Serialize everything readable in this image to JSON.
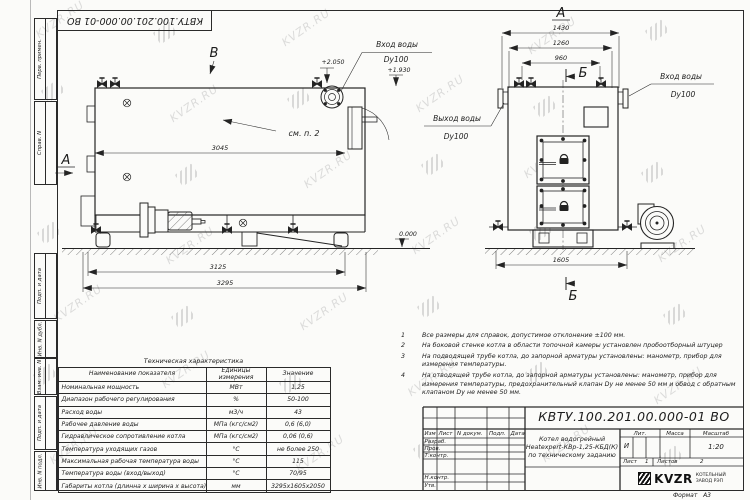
{
  "watermark": {
    "text": "KVZR.RU"
  },
  "frame": {
    "corner_stamp": "КВТУ.100.201.00.000-01 ВО",
    "margin_labels": [
      "Перв. примен.",
      "Справ. N",
      "Подп. и дата",
      "Инв. N дубл.",
      "Взам. инв. N",
      "Подп. и дата",
      "Инв. N подл."
    ]
  },
  "views": {
    "side": {
      "label": "В",
      "label_a": "А",
      "inlet": "Вход воды",
      "inlet_dn": "Dy100",
      "elev_top": "+2.050",
      "elev_mid": "+1.930",
      "elev_zero": "0.000",
      "see_note": "см. п. 2",
      "dim_inner": "3045",
      "dim_mid": "3125",
      "dim_total": "3295"
    },
    "front": {
      "label": "А",
      "section": "Б",
      "dim1": "1430",
      "dim2": "1260",
      "dim3": "960",
      "dim_base": "1605",
      "inlet": "Вход воды",
      "inlet_dn": "Dy100",
      "outlet": "Выход воды",
      "outlet_dn": "Dy100"
    }
  },
  "notes": {
    "items": [
      {
        "n": "1",
        "text": "Все размеры для справок, допустимое отклонение ±100 мм."
      },
      {
        "n": "2",
        "text": "На боковой стенке котла в области топочной камеры установлен пробоотборный штуцер"
      },
      {
        "n": "3",
        "text": "На  подводящей трубе котла, до запорной арматуры установлены: манометр, прибор для измерения температуры."
      },
      {
        "n": "4",
        "text": "На отводящей трубе котла, до запорной арматуры установлены: манометр, прибор для измерения температуры, предохранительный клапан Dу не менее 50 мм и обвод с обратным клапаном Dу не менее 50 мм."
      }
    ]
  },
  "spec_table": {
    "title": "Техническая характеристика",
    "headers": [
      "Наименование показателя",
      "Единицы измерения",
      "Значение"
    ],
    "rows": [
      [
        "Номинальная мощность",
        "МВт",
        "1,25"
      ],
      [
        "Диапазон рабочего регулирования",
        "%",
        "50-100"
      ],
      [
        "Расход воды",
        "м3/ч",
        "43"
      ],
      [
        "Рабочее давление воды",
        "МПа (кгс/см2)",
        "0,6 (6,0)"
      ],
      [
        "Гидравлическое сопротивление котла",
        "МПа (кгс/см2)",
        "0,06 (0,6)"
      ],
      [
        "Температура уходящих газов",
        "°С",
        "не более 250"
      ],
      [
        "Максимальная рабочая температура воды",
        "°С",
        "115"
      ],
      [
        "Температура воды (вход/выход)",
        "°С",
        "70/95"
      ],
      [
        "Габариты котла (длинна х ширина х высота)",
        "мм",
        "3295х1605х2050"
      ]
    ]
  },
  "title_block": {
    "doc_number": "КВТУ.100.201.00.000-01 ВО",
    "cols": [
      "Изм",
      "Лист",
      "N докум.",
      "Подп.",
      "Дата"
    ],
    "rows": [
      "Разраб.",
      "Пров.",
      "Т.контр.",
      "Н.контр.",
      "Утв."
    ],
    "product": [
      "Котел водогрейный",
      "Heatexpert-КВр-1,25-КБД(К)",
      "по техническому заданию"
    ],
    "lit_label": "Лит.",
    "lit_value": "И",
    "mass_label": "Масса",
    "scale_label": "Масштаб",
    "scale_value": "1:20",
    "sheet_label": "Лист",
    "sheet_value": "1",
    "sheets_label": "Листов",
    "sheets_value": "2",
    "logo": "KVZR",
    "company": [
      "КОТЕЛЬНЫЙ",
      "ЗАВОД РЭП"
    ],
    "format_label": "Формат",
    "format_value": "А3"
  }
}
